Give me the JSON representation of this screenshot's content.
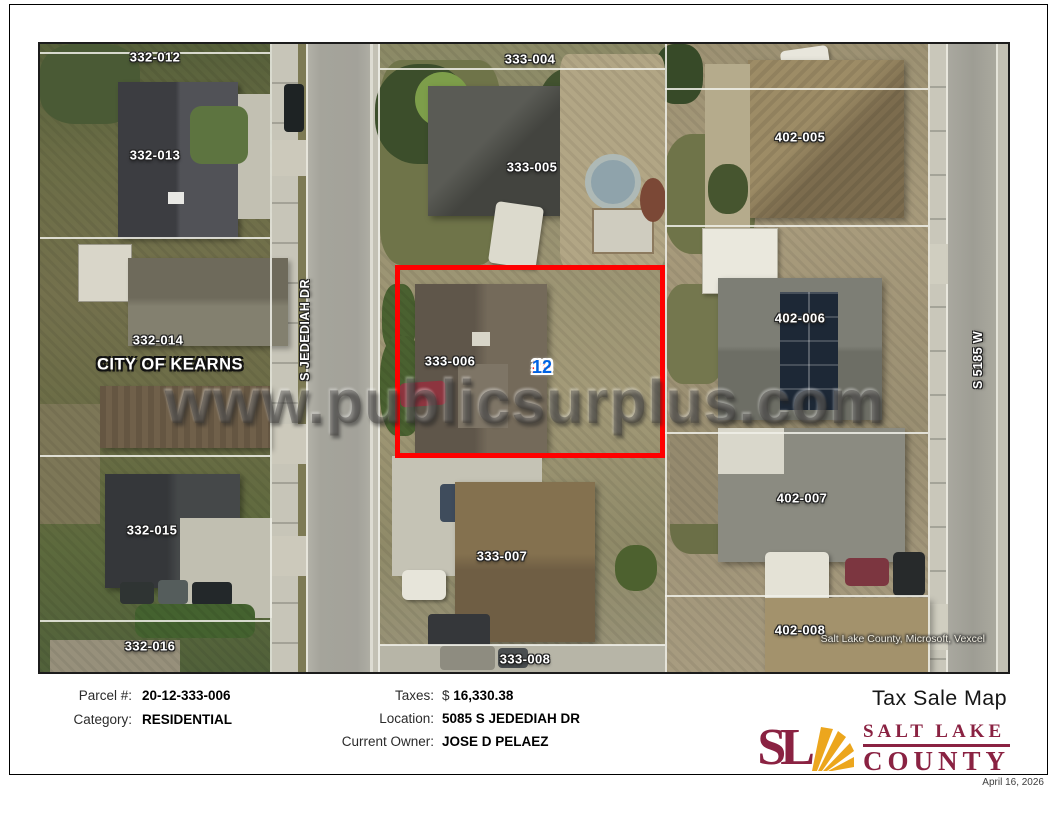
{
  "page": {
    "title": "Tax Sale Map",
    "date": "April 16, 2026"
  },
  "map": {
    "city": "CITY OF KEARNS",
    "watermark": "www.publicsurplus.com",
    "attribution": "Salt Lake County, Microsoft, Vexcel",
    "streets": [
      "S JEDEDIAH DR",
      "S 5185 W"
    ],
    "parcels": [
      "332-012",
      "333-004",
      "402-005",
      "332-013",
      "333-005",
      "332-014",
      "402-006",
      "333-006",
      "332-015",
      "402-007",
      "333-007",
      "332-016",
      "402-008",
      "333-008"
    ],
    "tag": {
      "left": "20",
      "sep": "-",
      "right": "12"
    }
  },
  "details": {
    "parcel_label": "Parcel #:",
    "parcel_value": "20-12-333-006",
    "category_label": "Category:",
    "category_value": "RESIDENTIAL",
    "taxes_label": "Taxes:",
    "taxes_currency": "$",
    "taxes_value": "16,330.38",
    "location_label": "Location:",
    "location_value": "5085 S JEDEDIAH DR",
    "owner_label": "Current Owner:",
    "owner_value": "JOSE D PELAEZ"
  },
  "logo": {
    "mark": "SL",
    "line1": "SALT LAKE",
    "line2": "COUNTY"
  },
  "colors": {
    "highlight_red": "#FF0000",
    "tag_blue": "#0062E3",
    "logo_maroon": "#8A2242",
    "logo_gold": "#ECA61D"
  }
}
